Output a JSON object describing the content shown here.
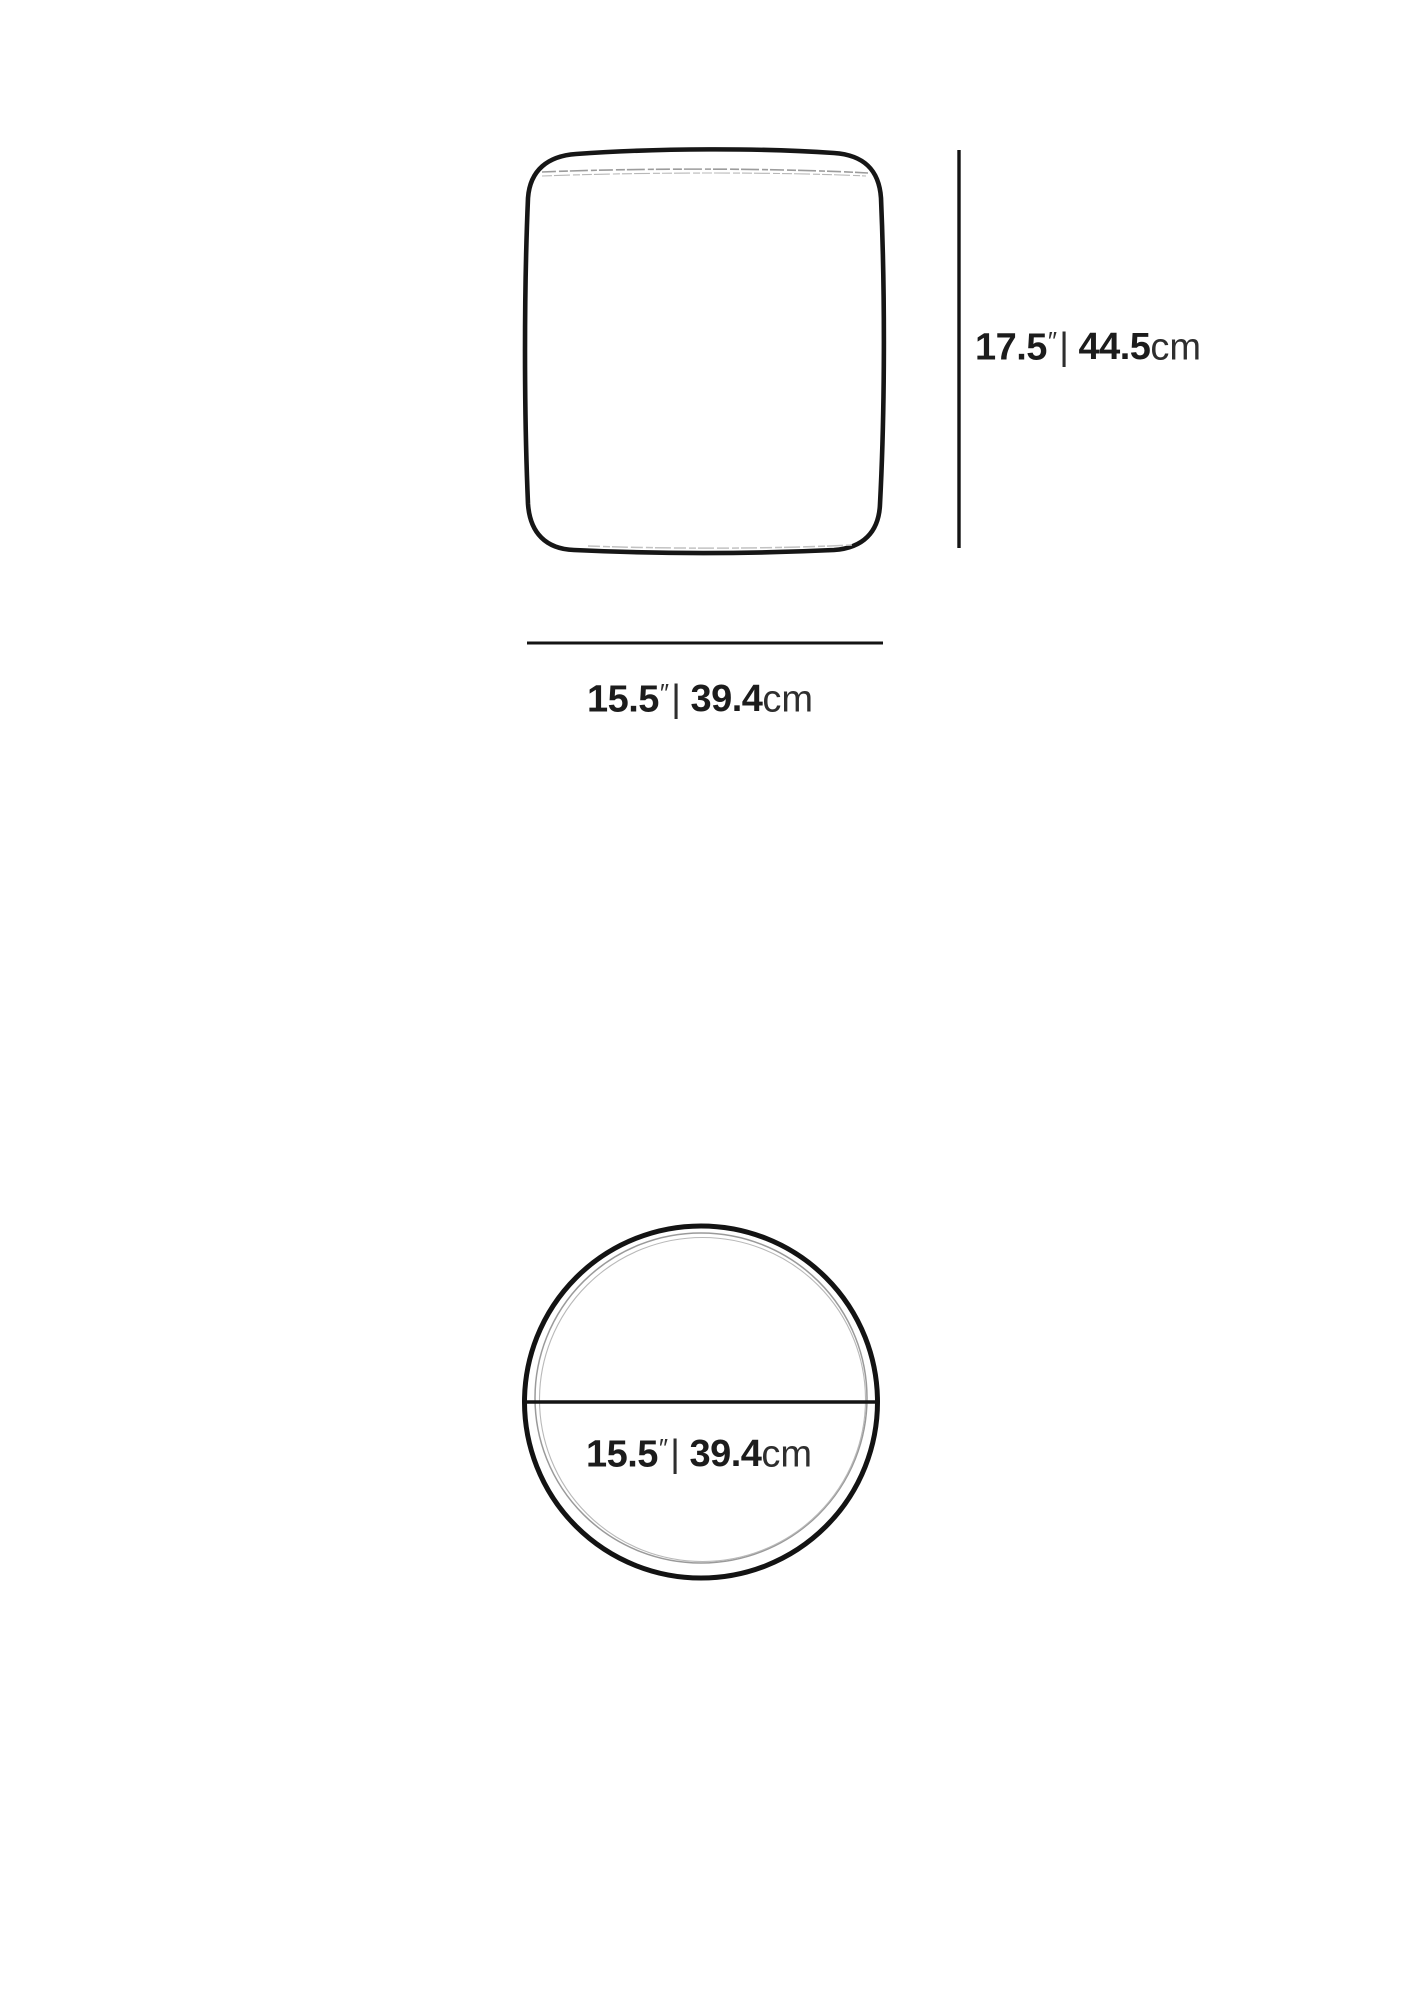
{
  "page": {
    "background_color": "#ffffff",
    "ink_color": "#161616",
    "stitch_color": "#a8a8a8",
    "seam_color": "#9a9a9a"
  },
  "front_view": {
    "height_label": {
      "imperial_value": "17.5",
      "inch_mark": "″",
      "separator": "|",
      "metric_value": "44.5",
      "unit": "cm"
    },
    "width_label": {
      "imperial_value": "15.5",
      "inch_mark": "″",
      "separator": "|",
      "metric_value": "39.4",
      "unit": "cm"
    }
  },
  "top_view": {
    "diameter_label": {
      "imperial_value": "15.5",
      "inch_mark": "″",
      "separator": "|",
      "metric_value": "39.4",
      "unit": "cm"
    }
  }
}
